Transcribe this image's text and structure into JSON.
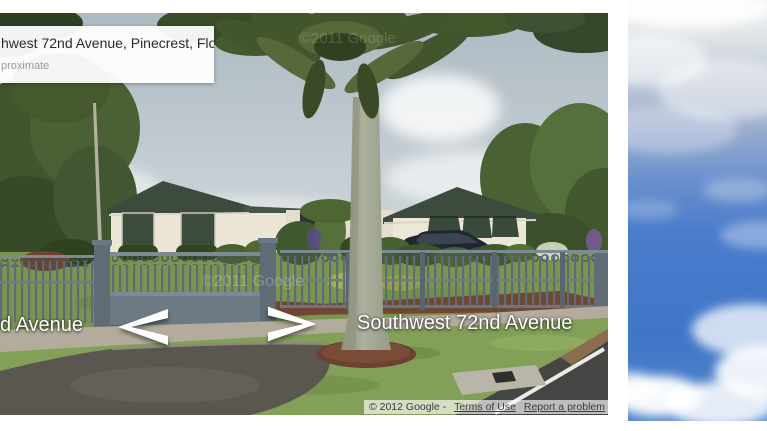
{
  "street_view": {
    "address_box": {
      "line1": "hwest 72nd Avenue, Pinecrest, Florida",
      "line2": "proximate"
    },
    "street_labels": {
      "left": "d Avenue",
      "center": "Southwest 72nd Avenue"
    },
    "navigation": {
      "left_arrow_icon": "chevron-left",
      "right_arrow_icon": "chevron-right"
    },
    "attribution": {
      "copyright_prefix": "© 2012 Google -",
      "terms_of_use": "Terms of Use",
      "report_a_problem": "Report a problem"
    },
    "watermark": "©2011 Google",
    "colors": {
      "sky_gray": "#bdc7cd",
      "palm_green": "#4a5c30",
      "roof_green": "#3d4a3e",
      "wall_cream": "#ebe6d5",
      "fence_gray": "#6d7984",
      "lawn_green": "#7a9550",
      "driveway_gray": "#5a5750",
      "label_white": "#ffffff",
      "attribution_text": "#3c3c3c"
    }
  },
  "side_photo": {
    "colors": {
      "sky_blue": "#4a7ccb",
      "cloud_white": "#ffffff"
    }
  }
}
